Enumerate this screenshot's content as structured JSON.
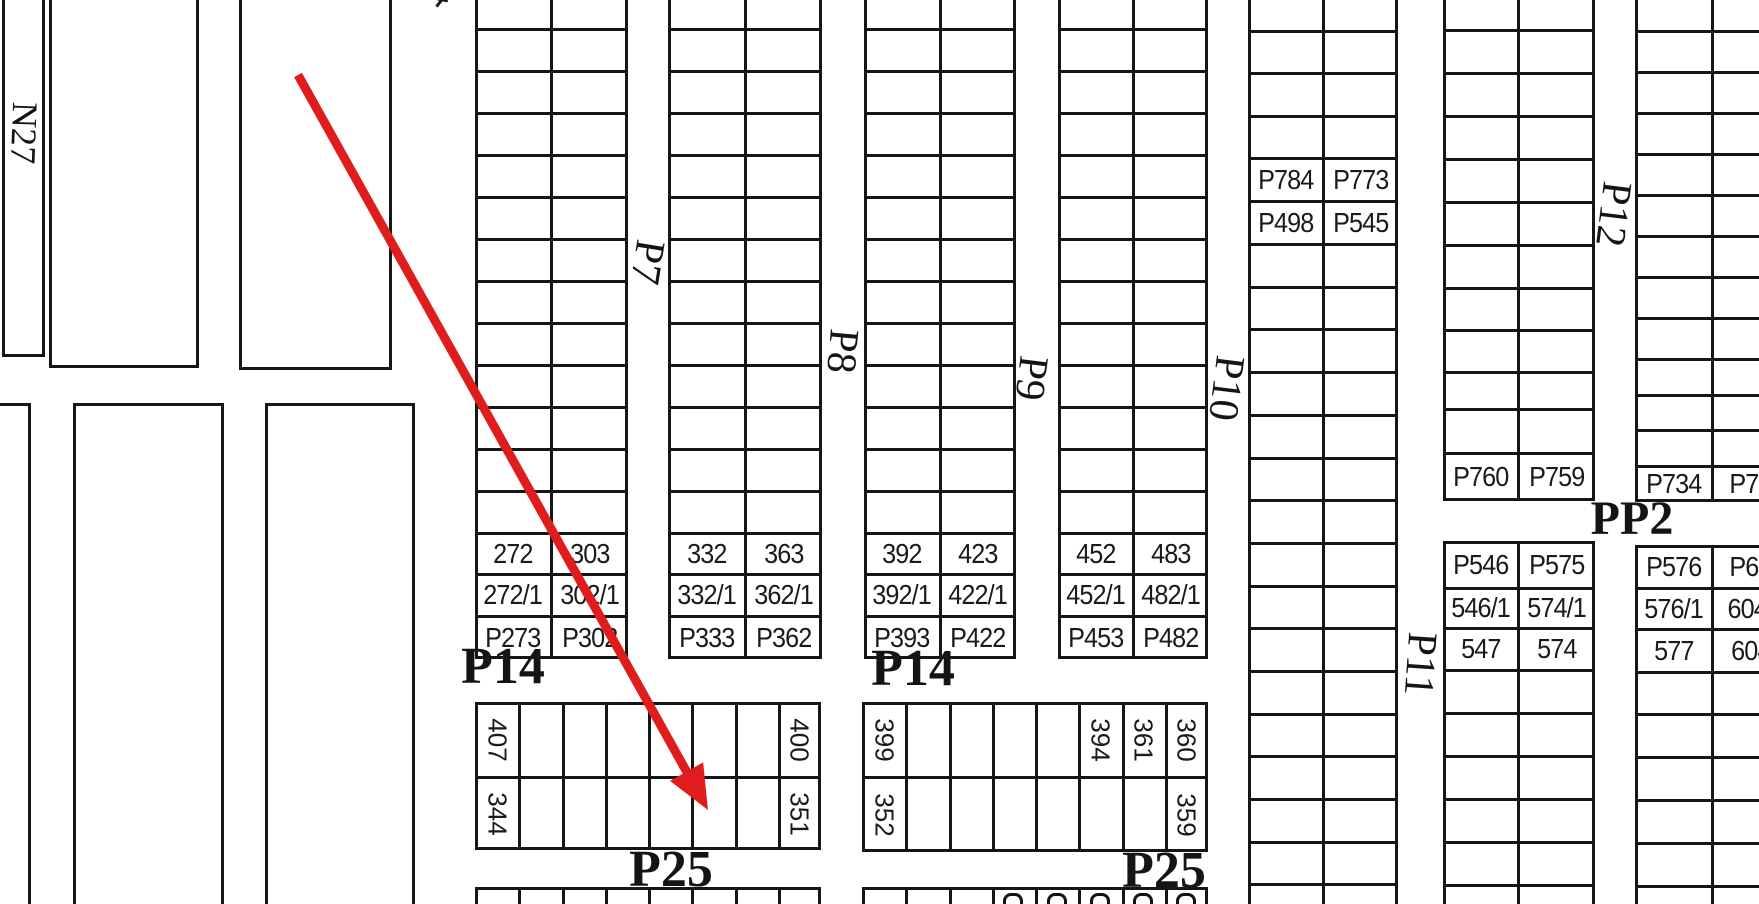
{
  "canvas": {
    "width": 1759,
    "height": 904
  },
  "colors": {
    "background": "#ffffff",
    "line": "#161616",
    "text": "#1a1a1a",
    "arrow_red": "#e01d1d"
  },
  "corner_label": {
    "text": "N27",
    "cx": 24,
    "cy": 133,
    "rot": 92,
    "size": 36
  },
  "road_labels": [
    {
      "text": "P7",
      "cx": 647,
      "cy": 262,
      "rot": 99,
      "size": 42
    },
    {
      "text": "P8",
      "cx": 842,
      "cy": 351,
      "rot": 95,
      "size": 42
    },
    {
      "text": "P9",
      "cx": 1031,
      "cy": 378,
      "rot": 97,
      "size": 42
    },
    {
      "text": "P10",
      "cx": 1226,
      "cy": 388,
      "rot": 97,
      "size": 42
    },
    {
      "text": "P11",
      "cx": 1420,
      "cy": 664,
      "rot": 94,
      "size": 42
    },
    {
      "text": "P12",
      "cx": 1613,
      "cy": 214,
      "rot": 97,
      "size": 42
    }
  ],
  "sections": [
    {
      "text": "P14",
      "cx": 503,
      "cy": 667,
      "size": 52
    },
    {
      "text": "P14",
      "cx": 913,
      "cy": 669,
      "size": 52
    },
    {
      "text": "P25",
      "cx": 671,
      "cy": 870,
      "size": 52
    },
    {
      "text": "P25",
      "cx": 1164,
      "cy": 871,
      "size": 52
    },
    {
      "text": "PP2",
      "cx": 1632,
      "cy": 519,
      "size": 48
    }
  ],
  "outline_rects": [
    {
      "x": 2,
      "y": -12,
      "w": 43,
      "h": 369
    },
    {
      "x": 49,
      "y": -12,
      "w": 150,
      "h": 380
    },
    {
      "x": 239,
      "y": -12,
      "w": 153,
      "h": 382
    },
    {
      "x": -20,
      "y": 403,
      "w": 51,
      "h": 545
    },
    {
      "x": 73,
      "y": 403,
      "w": 151,
      "h": 545
    },
    {
      "x": 265,
      "y": 403,
      "w": 150,
      "h": 545
    }
  ],
  "strips": [
    {
      "id": "A",
      "x": 475,
      "x2": 628,
      "divider": 551,
      "top": -13,
      "bottom": 659,
      "rowlines": [
        29,
        71,
        113,
        155,
        197,
        239,
        281,
        323,
        365,
        407,
        449,
        491,
        533,
        574,
        616
      ],
      "cells": [
        {
          "y1": 533,
          "y2": 574,
          "left": "272",
          "right": "303"
        },
        {
          "y1": 574,
          "y2": 616,
          "left": "272/1",
          "right": "302/1"
        },
        {
          "y1": 616,
          "y2": 659,
          "left": "P273",
          "right": "P302"
        }
      ]
    },
    {
      "id": "B",
      "x": 668,
      "x2": 822,
      "divider": 745,
      "top": -13,
      "bottom": 659,
      "rowlines": [
        29,
        71,
        113,
        155,
        197,
        239,
        281,
        323,
        365,
        407,
        449,
        491,
        533,
        574,
        616
      ],
      "cells": [
        {
          "y1": 533,
          "y2": 574,
          "left": "332",
          "right": "363"
        },
        {
          "y1": 574,
          "y2": 616,
          "left": "332/1",
          "right": "362/1"
        },
        {
          "y1": 616,
          "y2": 659,
          "left": "P333",
          "right": "P362"
        }
      ]
    },
    {
      "id": "C",
      "x": 864,
      "x2": 1016,
      "divider": 940,
      "top": -13,
      "bottom": 659,
      "rowlines": [
        29,
        71,
        113,
        155,
        197,
        239,
        281,
        323,
        365,
        407,
        449,
        491,
        533,
        574,
        616
      ],
      "cells": [
        {
          "y1": 533,
          "y2": 574,
          "left": "392",
          "right": "423"
        },
        {
          "y1": 574,
          "y2": 616,
          "left": "392/1",
          "right": "422/1"
        },
        {
          "y1": 616,
          "y2": 659,
          "left": "P393",
          "right": "P422"
        }
      ]
    },
    {
      "id": "D",
      "x": 1058,
      "x2": 1208,
      "divider": 1133,
      "top": -13,
      "bottom": 659,
      "rowlines": [
        29,
        71,
        113,
        155,
        197,
        239,
        281,
        323,
        365,
        407,
        449,
        491,
        533,
        574,
        616
      ],
      "cells": [
        {
          "y1": 533,
          "y2": 574,
          "left": "452",
          "right": "483"
        },
        {
          "y1": 574,
          "y2": 616,
          "left": "452/1",
          "right": "482/1"
        },
        {
          "y1": 616,
          "y2": 659,
          "left": "P453",
          "right": "P482"
        }
      ]
    },
    {
      "id": "E",
      "x": 1248,
      "x2": 1398,
      "divider": 1323,
      "top": -12,
      "bottom": 926,
      "rowlines": [
        31,
        73,
        116,
        158,
        201,
        244,
        287,
        329,
        372,
        415,
        458,
        500,
        543,
        586,
        628,
        671,
        714,
        756,
        799,
        842,
        884
      ],
      "cells": [
        {
          "y1": 158,
          "y2": 201,
          "left": "P784",
          "right": "P773"
        },
        {
          "y1": 201,
          "y2": 244,
          "left": "P498",
          "right": "P545"
        }
      ]
    },
    {
      "id": "F-upper",
      "x": 1443,
      "x2": 1595,
      "divider": 1518,
      "top": -13,
      "bottom": 501,
      "rowlines": [
        30,
        73,
        116,
        159,
        202,
        245,
        288,
        330,
        372,
        409,
        453
      ],
      "cells": [
        {
          "y1": 453,
          "y2": 501,
          "left": "P760",
          "right": "P759"
        }
      ]
    },
    {
      "id": "F-lower",
      "x": 1443,
      "x2": 1595,
      "divider": 1518,
      "top": 541,
      "bottom": 934,
      "rowlines": [
        588,
        628,
        670,
        713,
        756,
        799,
        842,
        885
      ],
      "cells": [
        {
          "y1": 541,
          "y2": 588,
          "left": "P546",
          "right": "P575"
        },
        {
          "y1": 588,
          "y2": 628,
          "left": "546/1",
          "right": "574/1"
        },
        {
          "y1": 628,
          "y2": 670,
          "left": "547",
          "right": "574"
        }
      ]
    },
    {
      "id": "G-upper",
      "x": 1635,
      "x2": 1789,
      "divider": 1712,
      "top": -10,
      "bottom": 502,
      "rowlines": [
        31,
        72,
        113,
        154,
        195,
        236,
        277,
        318,
        359,
        395,
        430,
        466
      ],
      "cells": [
        {
          "y1": 466,
          "y2": 502,
          "left": "P734",
          "right": "P73"
        }
      ]
    },
    {
      "id": "G-lower",
      "x": 1635,
      "x2": 1789,
      "divider": 1712,
      "top": 545,
      "bottom": 934,
      "rowlines": [
        588,
        629,
        672,
        714,
        757,
        800,
        843,
        886
      ],
      "cells": [
        {
          "y1": 545,
          "y2": 588,
          "left": "P576",
          "right": "P60"
        },
        {
          "y1": 588,
          "y2": 629,
          "left": "576/1",
          "right": "604/"
        },
        {
          "y1": 629,
          "y2": 672,
          "left": "577",
          "right": "604"
        }
      ]
    }
  ],
  "bottom_blocks": [
    {
      "x": 475,
      "y": 702,
      "x2": 821,
      "y2": 850,
      "cols": 8,
      "rowline": 777,
      "labels": [
        {
          "r": 0,
          "c": 0,
          "t": "407"
        },
        {
          "r": 0,
          "c": 7,
          "t": "400"
        },
        {
          "r": 1,
          "c": 0,
          "t": "344"
        },
        {
          "r": 1,
          "c": 7,
          "t": "351"
        }
      ]
    },
    {
      "x": 862,
      "y": 702,
      "x2": 1208,
      "y2": 852,
      "cols": 8,
      "rowline": 777,
      "labels": [
        {
          "r": 0,
          "c": 0,
          "t": "399"
        },
        {
          "r": 0,
          "c": 5,
          "t": "394"
        },
        {
          "r": 0,
          "c": 6,
          "t": "361"
        },
        {
          "r": 0,
          "c": 7,
          "t": "360"
        },
        {
          "r": 1,
          "c": 0,
          "t": "352"
        },
        {
          "r": 1,
          "c": 7,
          "t": "359"
        }
      ]
    },
    {
      "x": 475,
      "y": 887,
      "x2": 821,
      "y2": 934,
      "cols": 8,
      "rowline": null,
      "labels": []
    },
    {
      "x": 862,
      "y": 887,
      "x2": 1208,
      "y2": 934,
      "cols": 8,
      "rowline": null,
      "labels": [],
      "fragments": [
        3,
        4,
        5,
        6,
        7
      ]
    }
  ],
  "arrow": {
    "x1": 298,
    "y1": 75,
    "tipx": 708,
    "tipy": 810,
    "shaft_width": 9,
    "head_len": 44,
    "head_halfw": 19
  },
  "edge_marks": [
    {
      "x": 434,
      "y": -3
    }
  ]
}
